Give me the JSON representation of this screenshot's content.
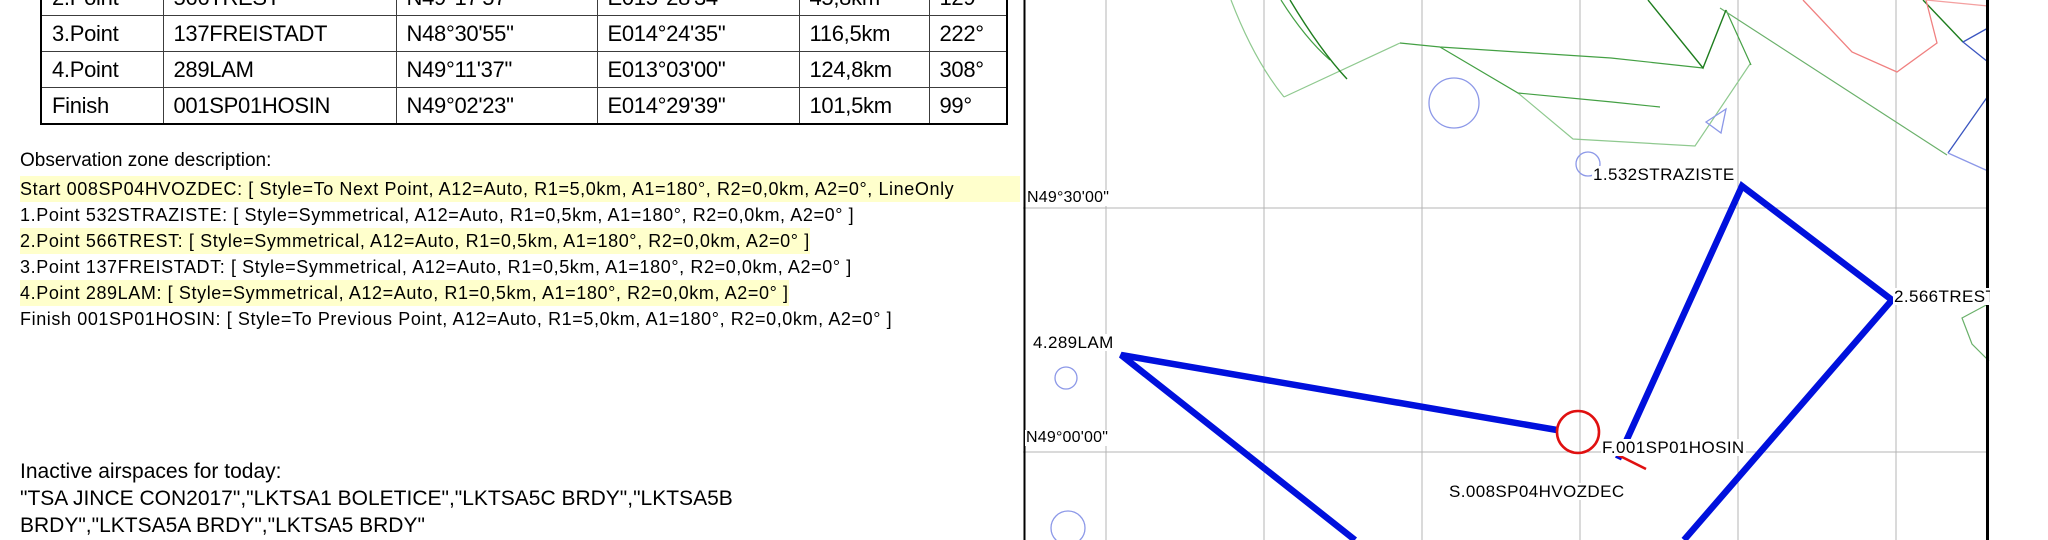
{
  "table": {
    "rows": [
      {
        "point": "2.Point",
        "name": "566TREST",
        "lat": "N49°17'57\"",
        "lon": "E015°28'34\"",
        "dist": "45,8km",
        "course": "129°"
      },
      {
        "point": "3.Point",
        "name": "137FREISTADT",
        "lat": "N48°30'55\"",
        "lon": "E014°24'35\"",
        "dist": "116,5km",
        "course": "222°"
      },
      {
        "point": "4.Point",
        "name": "289LAM",
        "lat": "N49°11'37\"",
        "lon": "E013°03'00\"",
        "dist": "124,8km",
        "course": "308°"
      },
      {
        "point": "Finish",
        "name": "001SP01HOSIN",
        "lat": "N49°02'23\"",
        "lon": "E014°29'39\"",
        "dist": "101,5km",
        "course": "99°"
      }
    ]
  },
  "observation": {
    "header": "Observation zone description:",
    "lines": [
      {
        "text": "Start 008SP04HVOZDEC: [ Style=To Next Point, A12=Auto, R1=5,0km, A1=180°, R2=0,0km, A2=0°, LineOnly",
        "highlight": true,
        "stretch": true
      },
      {
        "text": "1.Point 532STRAZISTE: [ Style=Symmetrical, A12=Auto, R1=0,5km, A1=180°, R2=0,0km, A2=0° ]",
        "highlight": false,
        "stretch": false
      },
      {
        "text": "2.Point 566TREST: [ Style=Symmetrical, A12=Auto, R1=0,5km, A1=180°, R2=0,0km, A2=0° ]",
        "highlight": true,
        "stretch": false
      },
      {
        "text": "3.Point 137FREISTADT: [ Style=Symmetrical, A12=Auto, R1=0,5km, A1=180°, R2=0,0km, A2=0° ]",
        "highlight": false,
        "stretch": false
      },
      {
        "text": "4.Point 289LAM: [ Style=Symmetrical, A12=Auto, R1=0,5km, A1=180°, R2=0,0km, A2=0° ]",
        "highlight": true,
        "stretch": false
      },
      {
        "text": "Finish 001SP01HOSIN: [ Style=To Previous Point, A12=Auto, R1=5,0km, A1=180°, R2=0,0km, A2=0° ]",
        "highlight": false,
        "stretch": false
      }
    ]
  },
  "inactive": {
    "header": "Inactive airspaces for today:",
    "lines": [
      "\"TSA JINCE CON2017\",\"LKTSA1 BOLETICE\",\"LKTSA5C BRDY\",\"LKTSA5B",
      "BRDY\",\"LKTSA5A BRDY\",\"LKTSA5 BRDY\""
    ]
  },
  "map": {
    "waypoint_labels": {
      "straziste": "1.532STRAZISTE",
      "trest": "2.566TREST",
      "lam": "4.289LAM",
      "hosin": "F.001SP01HOSIN",
      "hvozdec": "S.008SP04HVOZDEC"
    },
    "coord_labels": {
      "lat_30": "N49°30'00\"",
      "lat_00": "N49°00'00\""
    },
    "colors": {
      "task_line": "#0010dd",
      "start_finish_ring": "#e01010",
      "highlight_yellow": "#ffffcc",
      "airspace_green_dark": "#1e7d1e",
      "airspace_green_mid": "#44a044",
      "airspace_green_light": "#8fc98f",
      "airspace_red": "#f08080",
      "airspace_blue": "#3a55c0",
      "town_circle_blue": "#8c98e8",
      "grid_gray": "#b4b4b4"
    }
  }
}
